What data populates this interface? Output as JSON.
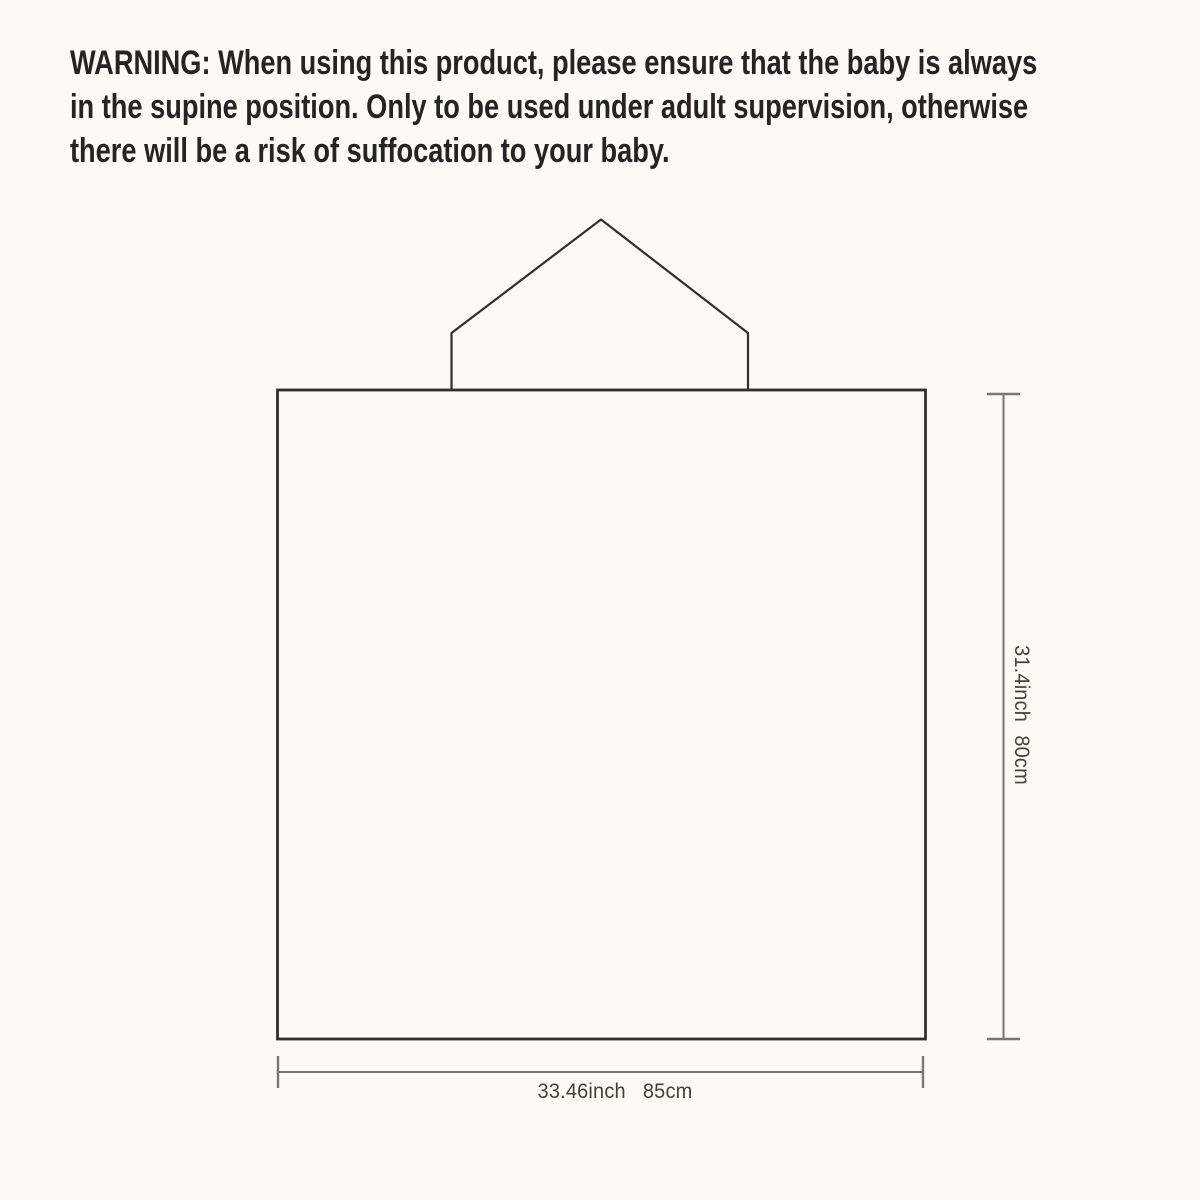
{
  "warning": {
    "lines": [
      "WARNING: When using this product, please ensure that the baby is always",
      "in the supine position. Only to be used under adult supervision, otherwise",
      "there will be a risk of suffocation to your baby."
    ]
  },
  "diagram": {
    "width_dimension": {
      "inches": "33.46inch",
      "centimeters": "85cm"
    },
    "height_dimension": {
      "inches": "31.4inch",
      "centimeters": "80cm"
    }
  },
  "colors": {
    "background": "#fcfaf4",
    "outline": "#352d2d",
    "dimension_line": "#7d7370",
    "warning_text": "#292224",
    "dimension_text": "#46403a"
  }
}
